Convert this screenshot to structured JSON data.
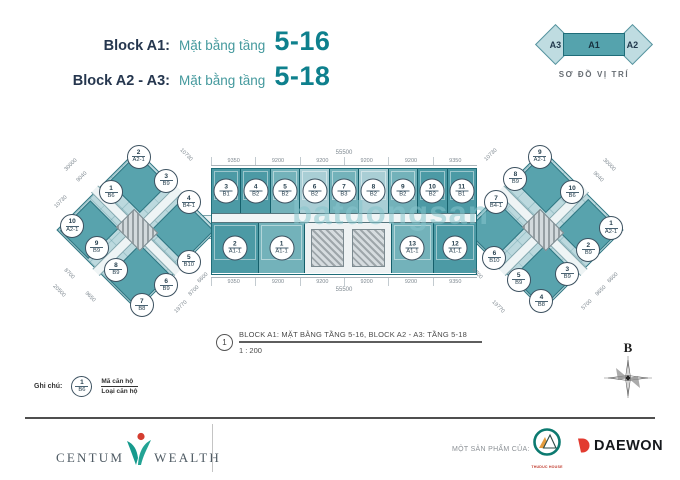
{
  "header": {
    "line1_label": "Block A1:",
    "line1_sub": "Mặt bằng tầng",
    "line1_range": "5-16",
    "line2_label": "Block A2 - A3:",
    "line2_sub": "Mặt bằng tầng",
    "line2_range": "5-18"
  },
  "location_diagram": {
    "blocks": [
      "A3",
      "A1",
      "A2"
    ],
    "caption": "SƠ ĐỒ VỊ TRÍ"
  },
  "plan": {
    "watermark": "batdongsan",
    "center_block": {
      "dim_total_top": "55500",
      "dims_top": [
        {
          "text": "9350"
        },
        {
          "text": "9200"
        },
        {
          "text": "9200"
        },
        {
          "text": "9200"
        },
        {
          "text": "9200"
        },
        {
          "text": "9350"
        }
      ],
      "top_units": [
        {
          "code": "3",
          "type": "B1",
          "shade": "dark"
        },
        {
          "code": "4",
          "type": "B2",
          "shade": "dark"
        },
        {
          "code": "5",
          "type": "B2",
          "shade": "mid"
        },
        {
          "code": "6",
          "type": "B2",
          "shade": "light"
        },
        {
          "code": "7",
          "type": "B3",
          "shade": "mid"
        },
        {
          "code": "8",
          "type": "B2",
          "shade": "light"
        },
        {
          "code": "9",
          "type": "B2",
          "shade": "mid"
        },
        {
          "code": "10",
          "type": "B2",
          "shade": "dark"
        },
        {
          "code": "11",
          "type": "B1",
          "shade": "dark"
        }
      ],
      "bottom_left_units": [
        {
          "code": "2",
          "type": "A1-1",
          "shade": "dark"
        },
        {
          "code": "1",
          "type": "A1-1",
          "shade": "mid"
        }
      ],
      "bottom_right_units": [
        {
          "code": "13",
          "type": "A1-1",
          "shade": "mid"
        },
        {
          "code": "12",
          "type": "A1-1",
          "shade": "dark"
        }
      ],
      "dims_bottom": [
        {
          "text": "9350"
        },
        {
          "text": "9200"
        },
        {
          "text": "9200"
        },
        {
          "text": "9200"
        },
        {
          "text": "9200"
        },
        {
          "text": "9350"
        }
      ],
      "dim_total_bottom": "55500"
    },
    "left_wing": {
      "units": [
        {
          "code": "2",
          "type": "A2-1",
          "x": 51,
          "y": 13
        },
        {
          "code": "3",
          "type": "B9",
          "x": 68,
          "y": 25
        },
        {
          "code": "1",
          "type": "B6",
          "x": 34,
          "y": 31
        },
        {
          "code": "4",
          "type": "B4-1",
          "x": 82,
          "y": 36
        },
        {
          "code": "10",
          "type": "A2-1",
          "x": 10,
          "y": 48
        },
        {
          "code": "9",
          "type": "B9",
          "x": 25,
          "y": 59
        },
        {
          "code": "8",
          "type": "B9",
          "x": 37,
          "y": 70
        },
        {
          "code": "5",
          "type": "B10",
          "x": 82,
          "y": 66
        },
        {
          "code": "6",
          "type": "B9",
          "x": 68,
          "y": 78
        },
        {
          "code": "7",
          "type": "B8",
          "x": 53,
          "y": 88
        }
      ],
      "dims": [
        {
          "text": "30000",
          "x": 9,
          "y": 17,
          "angle": -45
        },
        {
          "text": "9040",
          "x": 16,
          "y": 23,
          "angle": -45
        },
        {
          "text": "10730",
          "x": 80,
          "y": 12,
          "angle": 45
        },
        {
          "text": "10730",
          "x": 3,
          "y": 36,
          "angle": -45
        },
        {
          "text": "8700",
          "x": 8,
          "y": 72,
          "angle": 45
        },
        {
          "text": "20500",
          "x": 2,
          "y": 81,
          "angle": 45
        },
        {
          "text": "9650",
          "x": 21,
          "y": 84,
          "angle": 45
        },
        {
          "text": "6600",
          "x": 91,
          "y": 74,
          "angle": -45
        },
        {
          "text": "8700",
          "x": 85,
          "y": 81,
          "angle": -45
        },
        {
          "text": "19770",
          "x": 77,
          "y": 89,
          "angle": -45
        }
      ]
    },
    "right_wing": {
      "units": [
        {
          "code": "9",
          "type": "A2-1",
          "x": 48,
          "y": 13
        },
        {
          "code": "8",
          "type": "B9",
          "x": 33,
          "y": 24
        },
        {
          "code": "10",
          "type": "B6",
          "x": 68,
          "y": 31
        },
        {
          "code": "7",
          "type": "B4-1",
          "x": 21,
          "y": 36
        },
        {
          "code": "1",
          "type": "A2-1",
          "x": 92,
          "y": 49
        },
        {
          "code": "2",
          "type": "B9",
          "x": 78,
          "y": 60
        },
        {
          "code": "6",
          "type": "B10",
          "x": 20,
          "y": 64
        },
        {
          "code": "3",
          "type": "B9",
          "x": 65,
          "y": 72
        },
        {
          "code": "5",
          "type": "B9",
          "x": 35,
          "y": 75
        },
        {
          "code": "4",
          "type": "B8",
          "x": 49,
          "y": 86
        }
      ],
      "dims": [
        {
          "text": "10730",
          "x": 18,
          "y": 12,
          "angle": -45
        },
        {
          "text": "30000",
          "x": 91,
          "y": 17,
          "angle": 45
        },
        {
          "text": "9040",
          "x": 84,
          "y": 23,
          "angle": 45
        },
        {
          "text": "6700",
          "x": 9,
          "y": 72,
          "angle": 45
        },
        {
          "text": "19770",
          "x": 22,
          "y": 89,
          "angle": 45
        },
        {
          "text": "6600",
          "x": 93,
          "y": 74,
          "angle": -45
        },
        {
          "text": "9650",
          "x": 86,
          "y": 81,
          "angle": -45
        },
        {
          "text": "5700",
          "x": 77,
          "y": 88,
          "angle": -45
        }
      ]
    }
  },
  "caption": {
    "number": "1",
    "title": "BLOCK A1: MẶT BẰNG TẦNG 5-16, BLOCK A2 - A3: TẦNG 5-18",
    "scale": "1 : 200"
  },
  "legend": {
    "label": "Ghi chú:",
    "code": "1",
    "type": "B6",
    "line1": "Mã căn hộ",
    "line2": "Loại căn hộ"
  },
  "compass": {
    "label": "B"
  },
  "footer": {
    "brand_left": "CENTUM",
    "brand_right": "WEALTH",
    "product_label": "MỘT SẢN PHẨM CỦA:",
    "partner1": "THUDUC HOUSE",
    "partner2": "DAEWON"
  },
  "colors": {
    "navy": "#25364e",
    "teal_heading": "#0e808d",
    "teal_dark_fill": "#4c9aa5",
    "teal_mid_fill": "#73b2ba",
    "teal_light_fill": "#a9ced5",
    "plan_line": "#1f6d79",
    "dim_gray": "#7e8890",
    "logo_red": "#d43d30"
  }
}
